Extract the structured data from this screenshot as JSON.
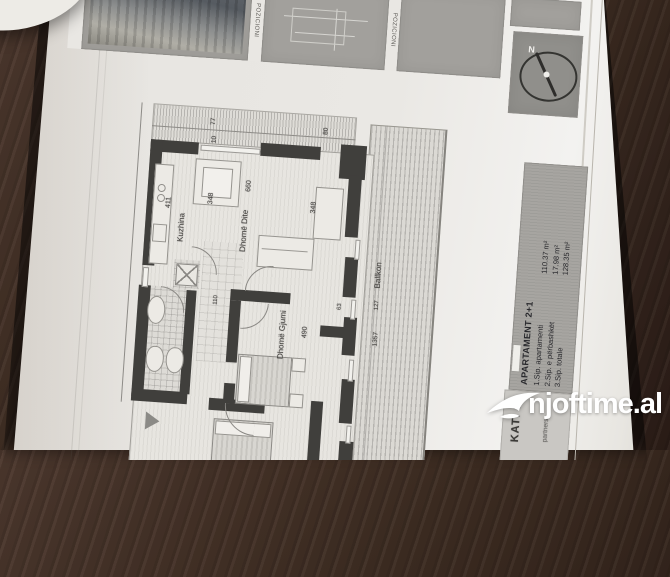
{
  "photo": {
    "watermark": {
      "text": "njoftime.al"
    }
  },
  "sheet": {
    "titleblock": {
      "panel_labels": [
        "POZICIONI",
        "POZICIONI"
      ],
      "compass_north": "N"
    },
    "info_panel": {
      "title": "APARTAMENT 2+1",
      "rows": [
        {
          "label": "1.Sip. apartamenti",
          "value": "110.37 m²"
        },
        {
          "label": "2.Sip. e përbashkët",
          "value": "17.98 m²"
        },
        {
          "label": "3.Sip. totale",
          "value": "128.35 m²"
        }
      ],
      "floor": "KATI 8",
      "firm": "partners"
    },
    "plan": {
      "rooms": {
        "kitchen": "Kuzhina",
        "living": "Dhomë Dite",
        "bedroom": "Dhomë Gjumi",
        "balcony": "Ballkon"
      },
      "dims": {
        "d77": "77",
        "d10": "10",
        "d80": "80",
        "d348a": "348",
        "d348b": "348",
        "d411": "411",
        "d660": "660",
        "d490": "490",
        "d110": "110",
        "d63": "63",
        "d127": "127",
        "d1357": "1357"
      }
    },
    "colors": {
      "wall": "#403f3c",
      "paper": "#eae8e4",
      "panel": "#a2a09c",
      "table": "#3d2c22",
      "watermark": "#ffffff"
    }
  }
}
